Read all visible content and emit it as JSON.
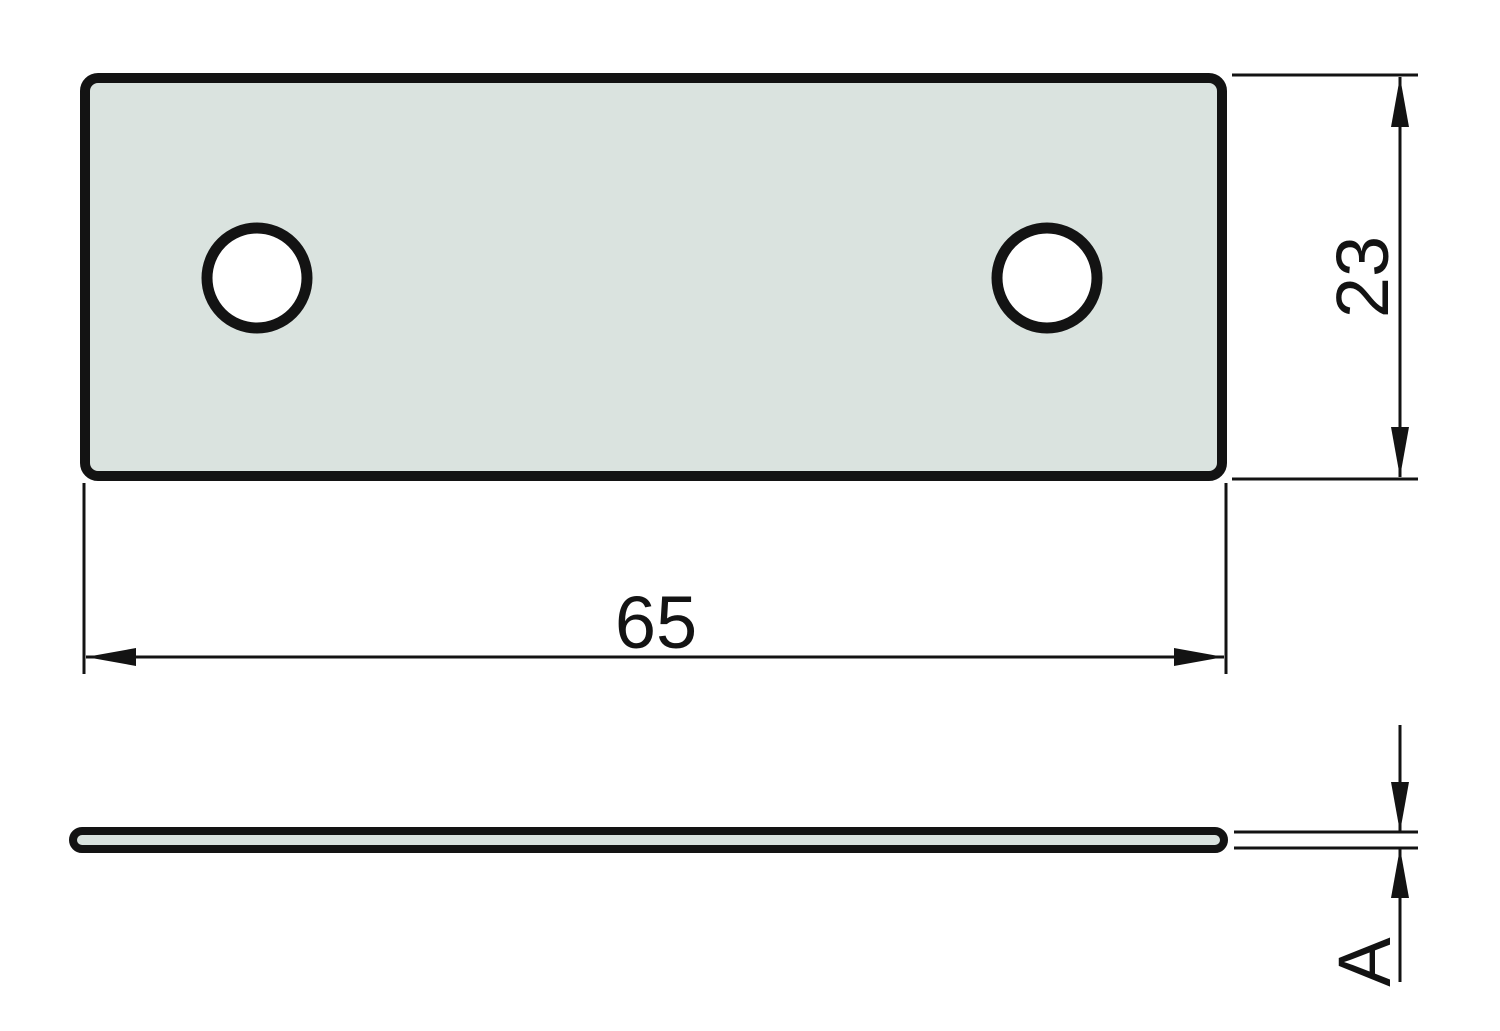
{
  "drawing": {
    "labels": {
      "width": "65",
      "height": "23",
      "thickness": "A"
    },
    "holes_count": 2,
    "colors": {
      "line": "#131313",
      "plate-fill": "#dae3df",
      "hole-fill": "#ffffff",
      "background": "#ffffff"
    }
  }
}
